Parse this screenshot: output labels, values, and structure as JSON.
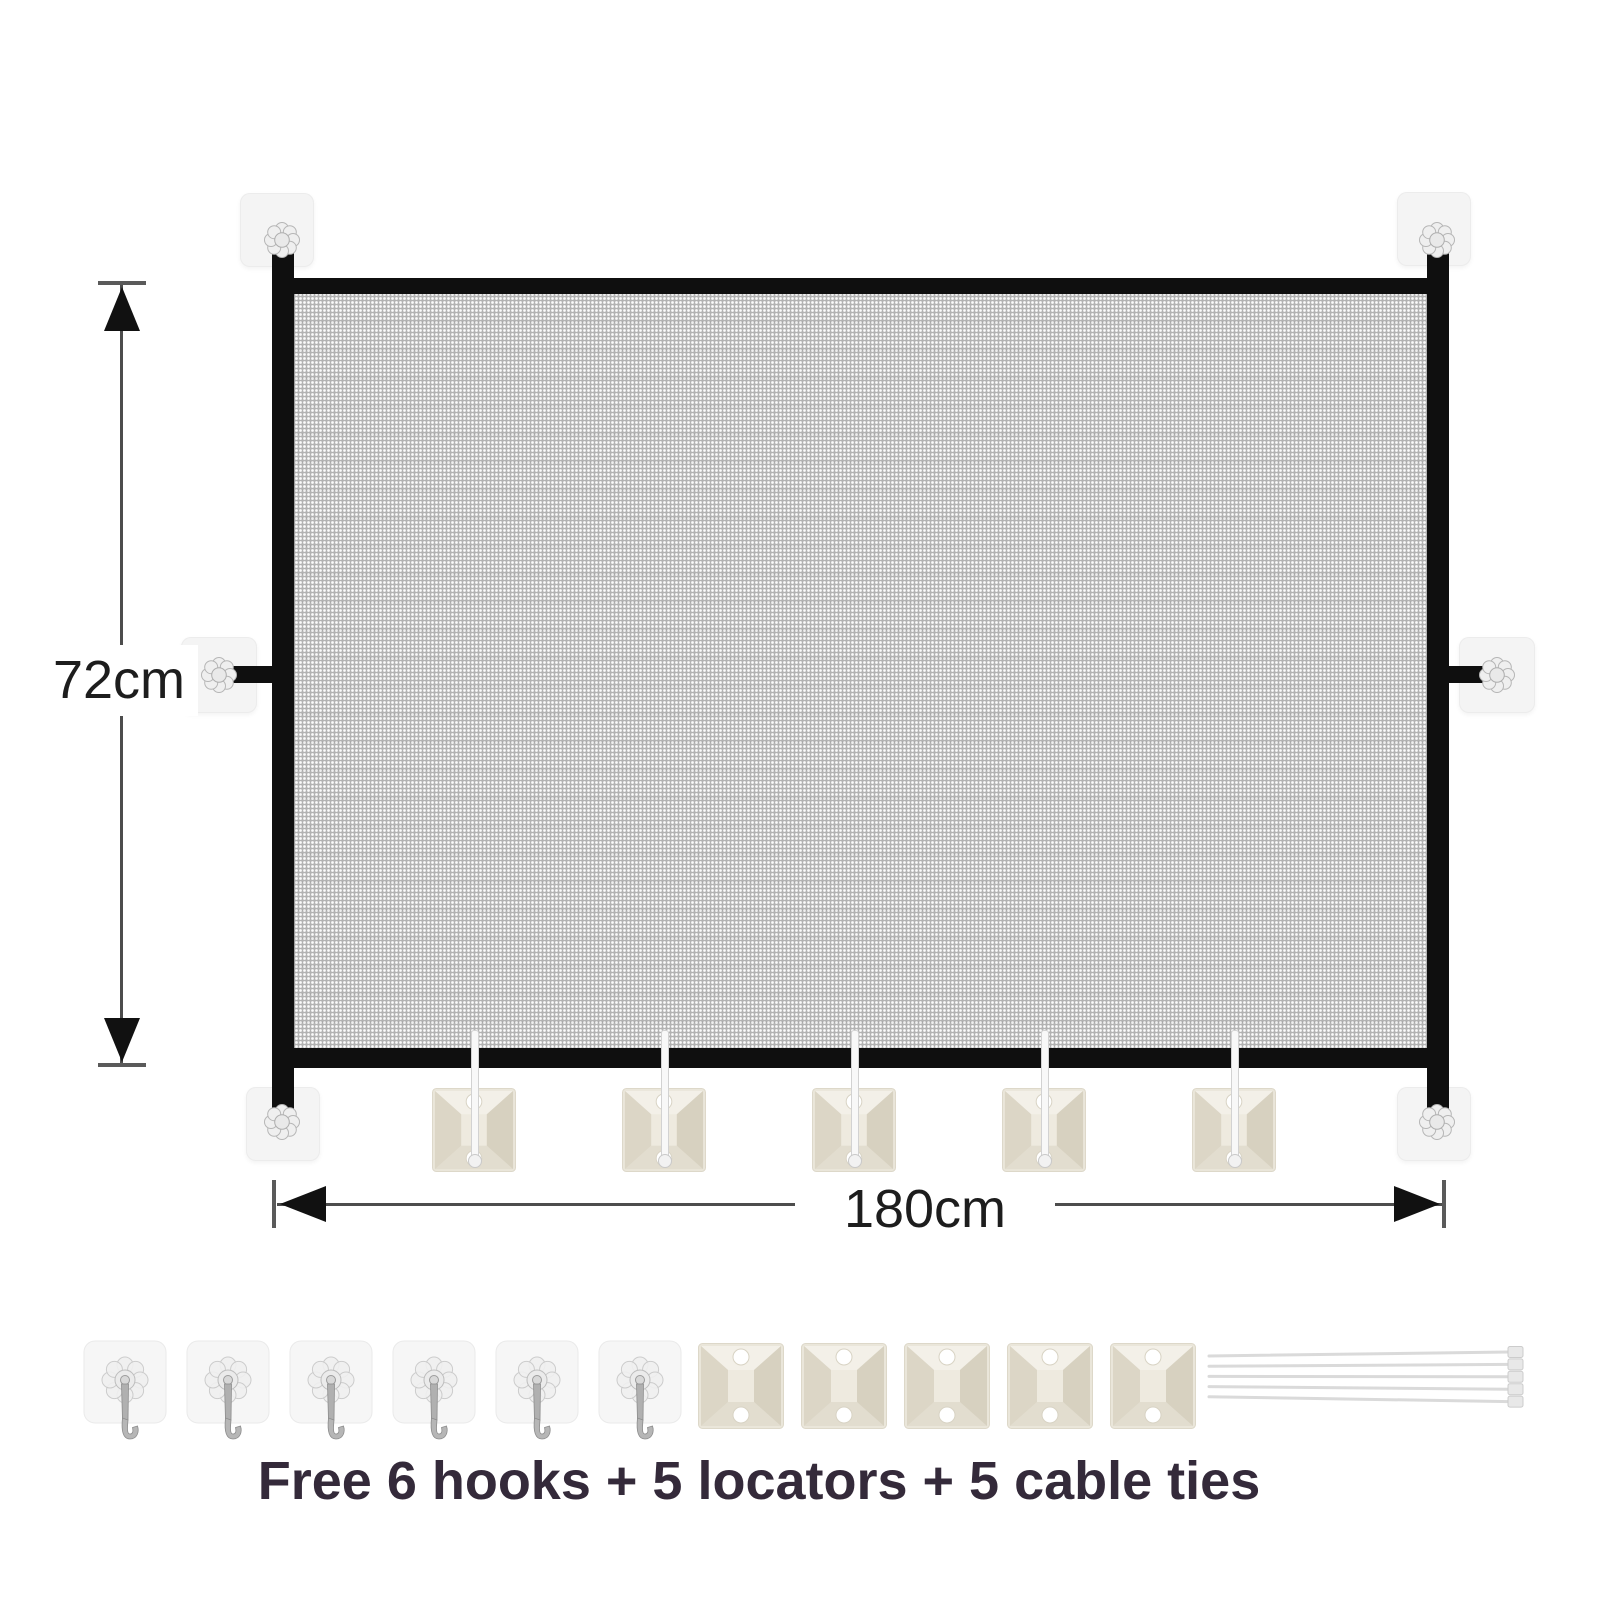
{
  "dimensions": {
    "height": {
      "label": "72cm"
    },
    "width": {
      "label": "180cm"
    }
  },
  "gate": {
    "frame_color": "#0f0f0f",
    "mesh_color": "#b2b2b2",
    "corner_pad_count": 4,
    "side_pad_count": 2,
    "hanging_locator_count": 5
  },
  "accessory_row": {
    "hooks": {
      "count": 6
    },
    "locators": {
      "count": 5
    },
    "cable_ties": {
      "count": 5
    }
  },
  "caption": {
    "text": "Free 6 hooks + 5 locators + 5 cable ties",
    "color": "#342a3a"
  }
}
